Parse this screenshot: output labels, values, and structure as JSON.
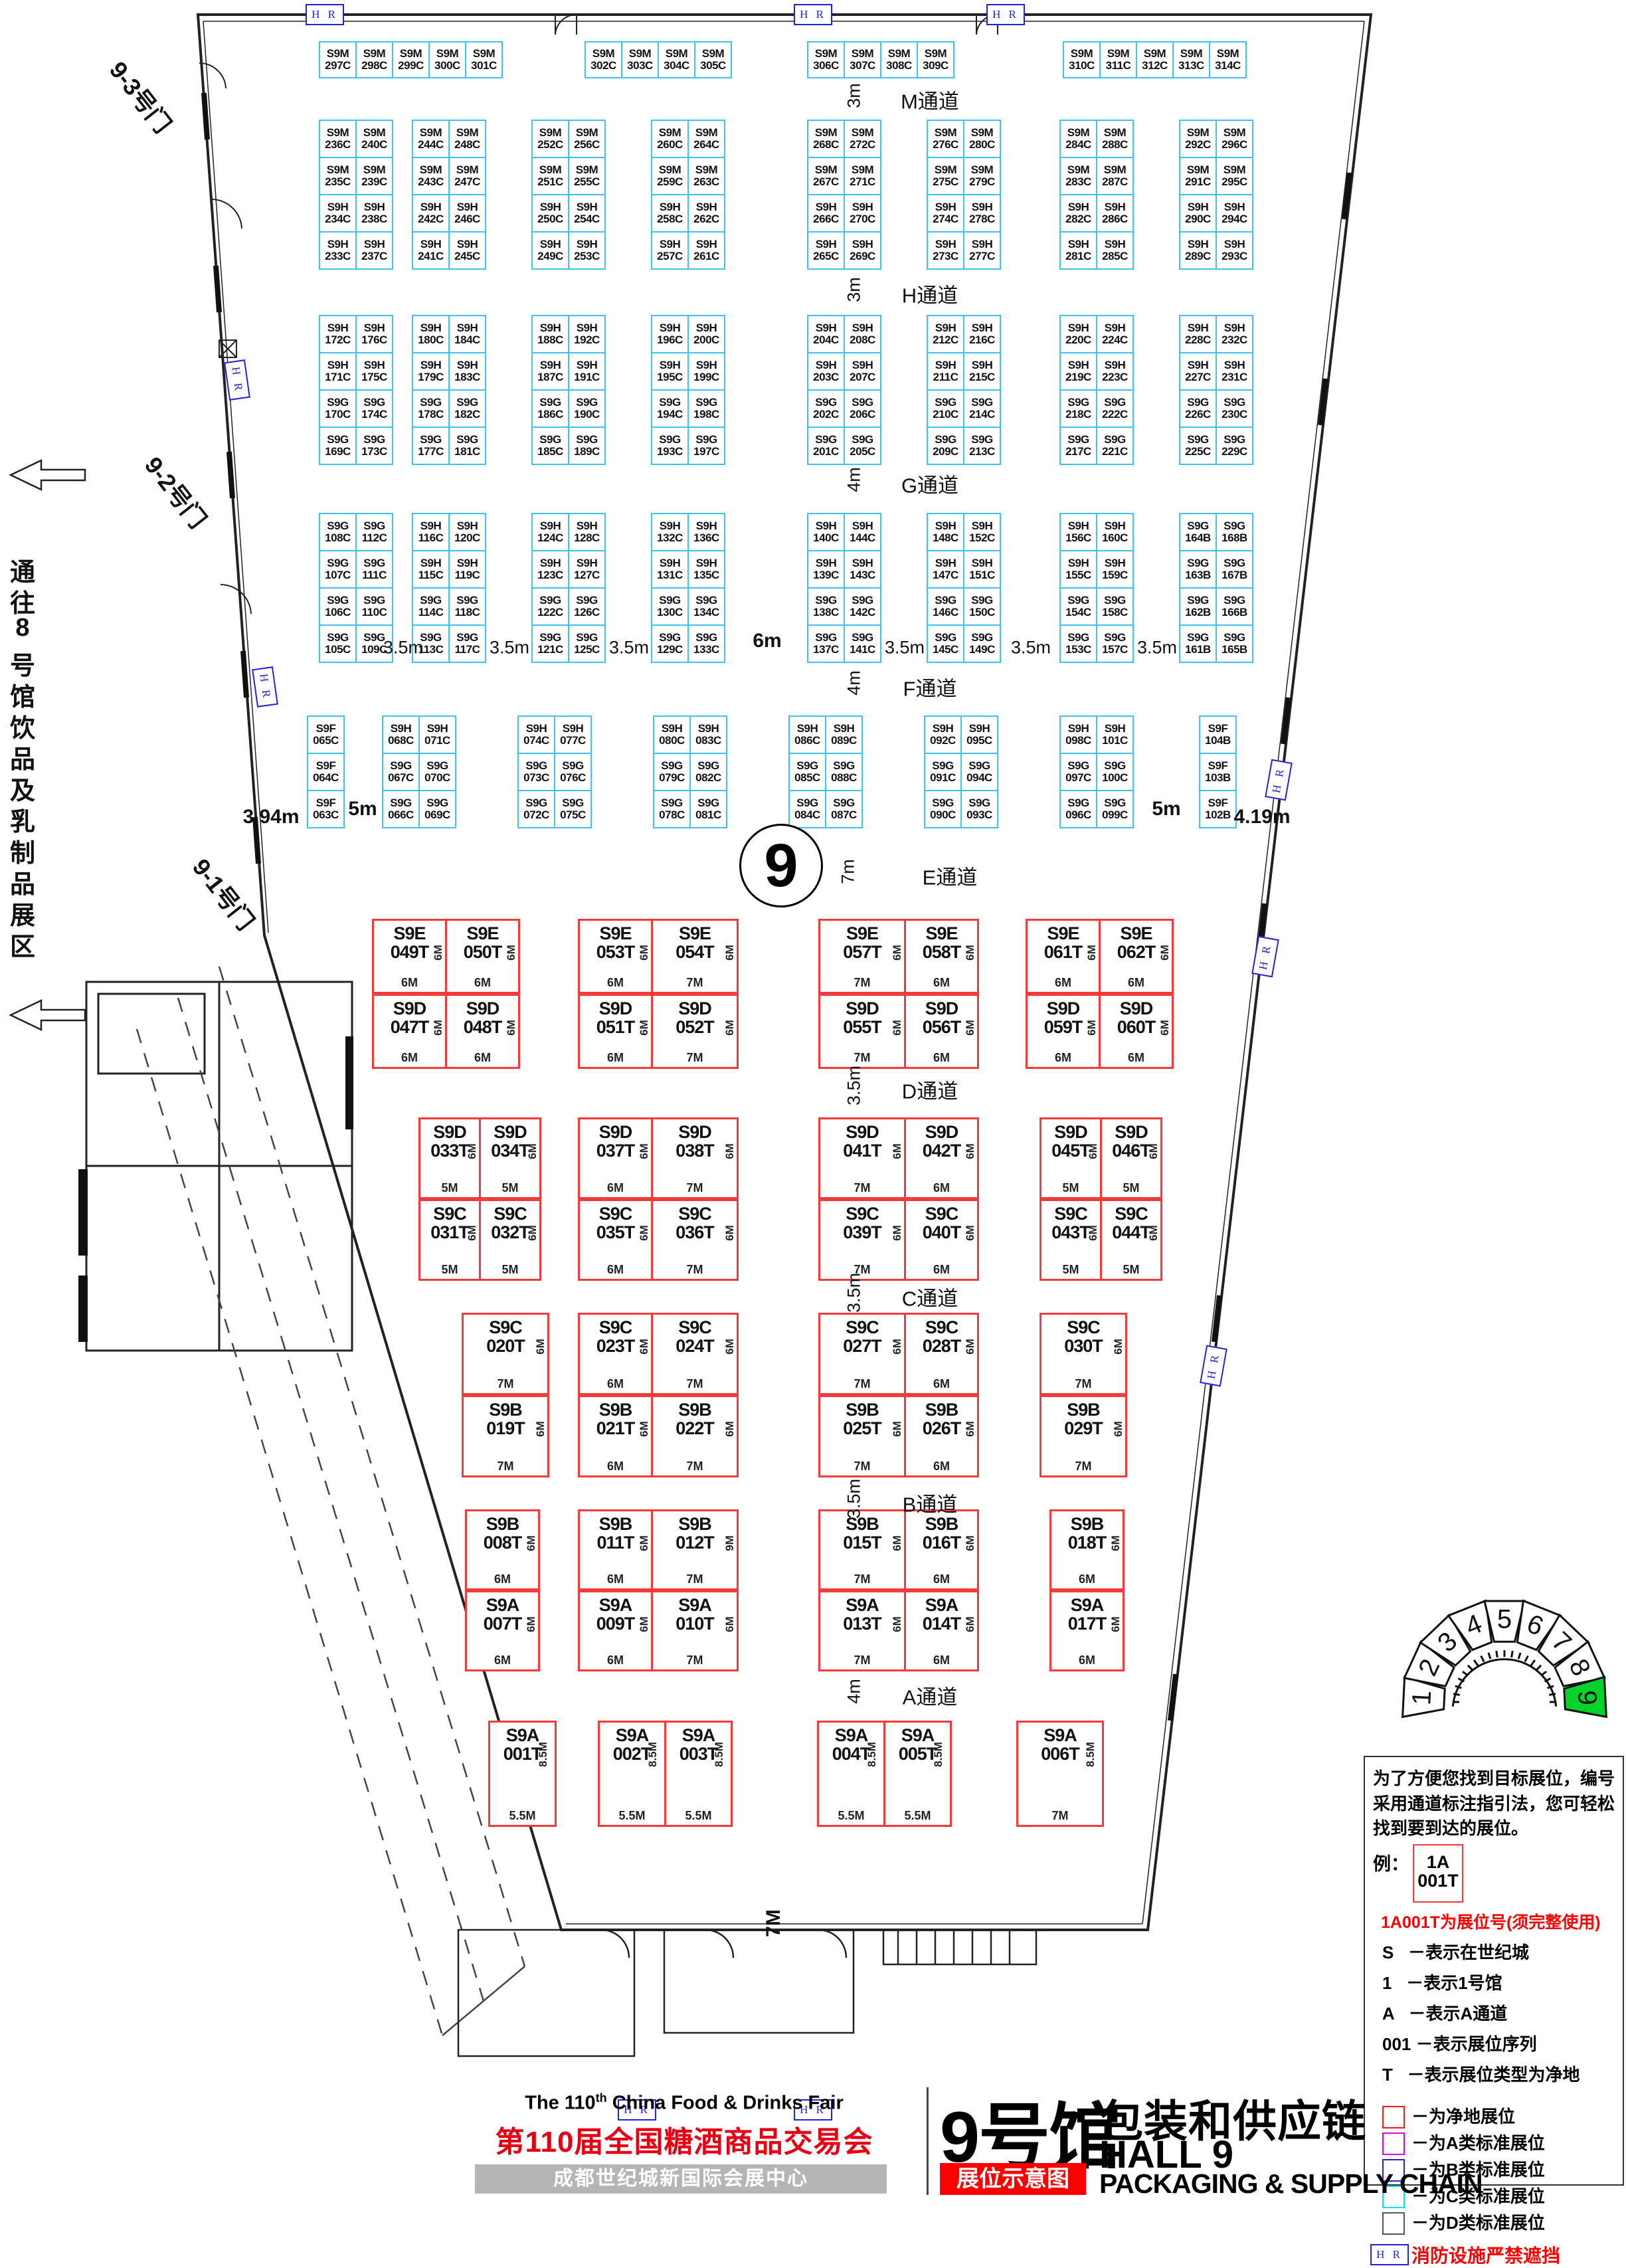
{
  "titles": {
    "en_pre": "The 110",
    "en_sup": "th",
    "en_post": " China Food & Drinks Fair",
    "cn": "第110届全国糖酒商品交易会",
    "venue": "成都世纪城新国际会展中心",
    "hall_cn_big": "9号馆",
    "hall_cn_sub": "包装和供应链",
    "hall_en": "HALL 9",
    "tag": "展位示意图",
    "en_sub": "PACKAGING & SUPPLY CHAIN"
  },
  "hall_circle": "9",
  "doors": [
    "9-3号门",
    "9-2号门",
    "9-1号门"
  ],
  "corridor_note": "通往8号馆饮品及乳制品展区",
  "fire_marker": "H R",
  "bottom_dim": "7M",
  "aisles": [
    {
      "label": "M通道",
      "dim": "3m"
    },
    {
      "label": "H通道",
      "dim": "3m"
    },
    {
      "label": "G通道",
      "dim": "4m"
    },
    {
      "label": "F通道",
      "dim": "4m"
    },
    {
      "label": "E通道",
      "dim": "7m"
    },
    {
      "label": "D通道",
      "dim": "3.5m"
    },
    {
      "label": "C通道",
      "dim": "3.5m"
    },
    {
      "label": "B通道",
      "dim": "3.5m"
    },
    {
      "label": "A通道",
      "dim": "4m"
    }
  ],
  "dim_labels": {
    "left": "3.94m",
    "right": "4.19m",
    "five": "5m",
    "gap": "3.5m",
    "mid": "6m"
  },
  "booths": {
    "row_m": [
      [
        "S9M|297C",
        "S9M|298C",
        "S9M|299C",
        "S9M|300C",
        "S9M|301C"
      ],
      [
        "S9M|302C",
        "S9M|303C",
        "S9M|304C",
        "S9M|305C"
      ],
      [
        "S9M|306C",
        "S9M|307C",
        "S9M|308C",
        "S9M|309C"
      ],
      [
        "S9M|310C",
        "S9M|311C",
        "S9M|312C",
        "S9M|313C",
        "S9M|314C"
      ]
    ],
    "block_mh": [
      [
        [
          "S9M|236C",
          "S9M|240C"
        ],
        [
          "S9M|235C",
          "S9M|239C"
        ],
        [
          "S9H|234C",
          "S9H|238C"
        ],
        [
          "S9H|233C",
          "S9H|237C"
        ]
      ],
      [
        [
          "S9M|244C",
          "S9M|248C"
        ],
        [
          "S9M|243C",
          "S9M|247C"
        ],
        [
          "S9H|242C",
          "S9H|246C"
        ],
        [
          "S9H|241C",
          "S9H|245C"
        ]
      ],
      [
        [
          "S9M|252C",
          "S9M|256C"
        ],
        [
          "S9M|251C",
          "S9M|255C"
        ],
        [
          "S9H|250C",
          "S9H|254C"
        ],
        [
          "S9H|249C",
          "S9H|253C"
        ]
      ],
      [
        [
          "S9M|260C",
          "S9M|264C"
        ],
        [
          "S9M|259C",
          "S9M|263C"
        ],
        [
          "S9H|258C",
          "S9H|262C"
        ],
        [
          "S9H|257C",
          "S9H|261C"
        ]
      ],
      [
        [
          "S9M|268C",
          "S9M|272C"
        ],
        [
          "S9M|267C",
          "S9M|271C"
        ],
        [
          "S9H|266C",
          "S9H|270C"
        ],
        [
          "S9H|265C",
          "S9H|269C"
        ]
      ],
      [
        [
          "S9M|276C",
          "S9M|280C"
        ],
        [
          "S9M|275C",
          "S9M|279C"
        ],
        [
          "S9H|274C",
          "S9H|278C"
        ],
        [
          "S9H|273C",
          "S9H|277C"
        ]
      ],
      [
        [
          "S9M|284C",
          "S9M|288C"
        ],
        [
          "S9M|283C",
          "S9M|287C"
        ],
        [
          "S9H|282C",
          "S9H|286C"
        ],
        [
          "S9H|281C",
          "S9H|285C"
        ]
      ],
      [
        [
          "S9M|292C",
          "S9M|296C"
        ],
        [
          "S9M|291C",
          "S9M|295C"
        ],
        [
          "S9H|290C",
          "S9H|294C"
        ],
        [
          "S9H|289C",
          "S9H|293C"
        ]
      ]
    ],
    "block_hg": [
      [
        [
          "S9H|172C",
          "S9H|176C"
        ],
        [
          "S9H|171C",
          "S9H|175C"
        ],
        [
          "S9G|170C",
          "S9G|174C"
        ],
        [
          "S9G|169C",
          "S9G|173C"
        ]
      ],
      [
        [
          "S9H|180C",
          "S9H|184C"
        ],
        [
          "S9H|179C",
          "S9H|183C"
        ],
        [
          "S9G|178C",
          "S9G|182C"
        ],
        [
          "S9G|177C",
          "S9G|181C"
        ]
      ],
      [
        [
          "S9H|188C",
          "S9H|192C"
        ],
        [
          "S9H|187C",
          "S9H|191C"
        ],
        [
          "S9G|186C",
          "S9G|190C"
        ],
        [
          "S9G|185C",
          "S9G|189C"
        ]
      ],
      [
        [
          "S9H|196C",
          "S9H|200C"
        ],
        [
          "S9H|195C",
          "S9H|199C"
        ],
        [
          "S9G|194C",
          "S9G|198C"
        ],
        [
          "S9G|193C",
          "S9G|197C"
        ]
      ],
      [
        [
          "S9H|204C",
          "S9H|208C"
        ],
        [
          "S9H|203C",
          "S9H|207C"
        ],
        [
          "S9G|202C",
          "S9G|206C"
        ],
        [
          "S9G|201C",
          "S9G|205C"
        ]
      ],
      [
        [
          "S9H|212C",
          "S9H|216C"
        ],
        [
          "S9H|211C",
          "S9H|215C"
        ],
        [
          "S9G|210C",
          "S9G|214C"
        ],
        [
          "S9G|209C",
          "S9G|213C"
        ]
      ],
      [
        [
          "S9H|220C",
          "S9H|224C"
        ],
        [
          "S9H|219C",
          "S9H|223C"
        ],
        [
          "S9G|218C",
          "S9G|222C"
        ],
        [
          "S9G|217C",
          "S9G|221C"
        ]
      ],
      [
        [
          "S9H|228C",
          "S9H|232C"
        ],
        [
          "S9H|227C",
          "S9H|231C"
        ],
        [
          "S9G|226C",
          "S9G|230C"
        ],
        [
          "S9G|225C",
          "S9G|229C"
        ]
      ]
    ],
    "block_gf": [
      [
        [
          "S9G|108C",
          "S9G|112C"
        ],
        [
          "S9G|107C",
          "S9G|111C"
        ],
        [
          "S9G|106C",
          "S9G|110C"
        ],
        [
          "S9G|105C",
          "S9G|109C"
        ]
      ],
      [
        [
          "S9H|116C",
          "S9H|120C"
        ],
        [
          "S9H|115C",
          "S9H|119C"
        ],
        [
          "S9G|114C",
          "S9G|118C"
        ],
        [
          "S9G|113C",
          "S9G|117C"
        ]
      ],
      [
        [
          "S9H|124C",
          "S9H|128C"
        ],
        [
          "S9H|123C",
          "S9H|127C"
        ],
        [
          "S9G|122C",
          "S9G|126C"
        ],
        [
          "S9G|121C",
          "S9G|125C"
        ]
      ],
      [
        [
          "S9H|132C",
          "S9H|136C"
        ],
        [
          "S9H|131C",
          "S9H|135C"
        ],
        [
          "S9G|130C",
          "S9G|134C"
        ],
        [
          "S9G|129C",
          "S9G|133C"
        ]
      ],
      [
        [
          "S9H|140C",
          "S9H|144C"
        ],
        [
          "S9H|139C",
          "S9H|143C"
        ],
        [
          "S9G|138C",
          "S9G|142C"
        ],
        [
          "S9G|137C",
          "S9G|141C"
        ]
      ],
      [
        [
          "S9H|148C",
          "S9H|152C"
        ],
        [
          "S9H|147C",
          "S9H|151C"
        ],
        [
          "S9G|146C",
          "S9G|150C"
        ],
        [
          "S9G|145C",
          "S9G|149C"
        ]
      ],
      [
        [
          "S9H|156C",
          "S9H|160C"
        ],
        [
          "S9H|155C",
          "S9H|159C"
        ],
        [
          "S9G|154C",
          "S9G|158C"
        ],
        [
          "S9G|153C",
          "S9G|157C"
        ]
      ],
      [
        [
          "S9G|164B",
          "S9G|168B"
        ],
        [
          "S9G|163B",
          "S9G|167B"
        ],
        [
          "S9G|162B",
          "S9G|166B"
        ],
        [
          "S9G|161B",
          "S9G|165B"
        ]
      ]
    ],
    "f_left": [
      "S9F|065C",
      "S9F|064C",
      "S9F|063C"
    ],
    "block_fe": [
      [
        [
          "S9H|068C",
          "S9H|071C"
        ],
        [
          "S9G|067C",
          "S9G|070C"
        ],
        [
          "S9G|066C",
          "S9G|069C"
        ]
      ],
      [
        [
          "S9H|074C",
          "S9H|077C"
        ],
        [
          "S9G|073C",
          "S9G|076C"
        ],
        [
          "S9G|072C",
          "S9G|075C"
        ]
      ],
      [
        [
          "S9H|080C",
          "S9H|083C"
        ],
        [
          "S9G|079C",
          "S9G|082C"
        ],
        [
          "S9G|078C",
          "S9G|081C"
        ]
      ],
      [
        [
          "S9H|086C",
          "S9H|089C"
        ],
        [
          "S9G|085C",
          "S9G|088C"
        ],
        [
          "S9G|084C",
          "S9G|087C"
        ]
      ],
      [
        [
          "S9H|092C",
          "S9H|095C"
        ],
        [
          "S9G|091C",
          "S9G|094C"
        ],
        [
          "S9G|090C",
          "S9G|093C"
        ]
      ],
      [
        [
          "S9H|098C",
          "S9H|101C"
        ],
        [
          "S9G|097C",
          "S9G|100C"
        ],
        [
          "S9G|096C",
          "S9G|099C"
        ]
      ]
    ],
    "f_right": [
      "S9F|104B",
      "S9F|103B",
      "S9F|102B"
    ],
    "red_ed": [
      [
        [
          "S9E|049T|6M|6M",
          "S9E|050T|6M|6M"
        ],
        [
          "S9D|047T|6M|6M",
          "S9D|048T|6M|6M"
        ]
      ],
      [
        [
          "S9E|053T|6M|6M",
          "S9E|054T|6M|7M"
        ],
        [
          "S9D|051T|6M|6M",
          "S9D|052T|6M|7M"
        ]
      ],
      [
        [
          "S9E|057T|6M|7M",
          "S9E|058T|6M|6M"
        ],
        [
          "S9D|055T|6M|7M",
          "S9D|056T|6M|6M"
        ]
      ],
      [
        [
          "S9E|061T|6M|6M",
          "S9E|062T|6M|6M"
        ],
        [
          "S9D|059T|6M|6M",
          "S9D|060T|6M|6M"
        ]
      ]
    ],
    "red_dc": [
      [
        [
          "S9D|033T|6M|5M",
          "S9D|034T|6M|5M"
        ],
        [
          "S9C|031T|6M|5M",
          "S9C|032T|6M|5M"
        ]
      ],
      [
        [
          "S9D|037T|6M|6M",
          "S9D|038T|6M|7M"
        ],
        [
          "S9C|035T|6M|6M",
          "S9C|036T|6M|7M"
        ]
      ],
      [
        [
          "S9D|041T|6M|7M",
          "S9D|042T|6M|6M"
        ],
        [
          "S9C|039T|6M|7M",
          "S9C|040T|6M|6M"
        ]
      ],
      [
        [
          "S9D|045T|6M|5M",
          "S9D|046T|6M|5M"
        ],
        [
          "S9C|043T|6M|5M",
          "S9C|044T|6M|5M"
        ]
      ]
    ],
    "red_cb": [
      [
        [
          "S9C|020T|6M|7M"
        ],
        [
          "S9B|019T|6M|7M"
        ]
      ],
      [
        [
          "S9C|023T|6M|6M",
          "S9C|024T|6M|7M"
        ],
        [
          "S9B|021T|6M|6M",
          "S9B|022T|6M|7M"
        ]
      ],
      [
        [
          "S9C|027T|6M|7M",
          "S9C|028T|6M|6M"
        ],
        [
          "S9B|025T|6M|7M",
          "S9B|026T|6M|6M"
        ]
      ],
      [
        [
          "S9C|030T|6M|7M"
        ],
        [
          "S9B|029T|6M|7M"
        ]
      ]
    ],
    "red_ba": [
      [
        [
          "S9B|008T|6M|6M"
        ],
        [
          "S9A|007T|6M|6M"
        ]
      ],
      [
        [
          "S9B|011T|6M|6M",
          "S9B|012T|9M|7M"
        ],
        [
          "S9A|009T|6M|6M",
          "S9A|010T|6M|7M"
        ]
      ],
      [
        [
          "S9B|015T|6M|7M",
          "S9B|016T|6M|6M"
        ],
        [
          "S9A|013T|6M|7M",
          "S9A|014T|6M|6M"
        ]
      ],
      [
        [
          "S9B|018T|6M|6M"
        ],
        [
          "S9A|017T|6M|6M"
        ]
      ]
    ],
    "red_a": [
      [
        [
          "S9A|001T|8.5M|5.5M"
        ]
      ],
      [
        [
          "S9A|002T|8.5M|5.5M",
          "S9A|003T|8.5M|5.5M"
        ]
      ],
      [
        [
          "S9A|004T|8.5M|5.5M",
          "S9A|005T|8.5M|5.5M"
        ]
      ],
      [
        [
          "S9A|006T|8.5M|7M"
        ]
      ]
    ]
  },
  "legend": {
    "intro": "为了方便您找到目标展位，编号采用通道标注指引法，您可轻松找到要到达的展位。",
    "example_label": "例：",
    "example_line1": "1A",
    "example_line2": "001T",
    "note": "1A001T为展位号(须完整使用)",
    "keys": [
      {
        "k": "S",
        "d": "－表示在世纪城"
      },
      {
        "k": "1",
        "d": "－表示1号馆"
      },
      {
        "k": "A",
        "d": "－表示A通道"
      },
      {
        "k": "001",
        "d": "－表示展位序列"
      },
      {
        "k": "T",
        "d": "－表示展位类型为净地"
      }
    ],
    "swatches": [
      {
        "color": "#ff1a1a",
        "label": "－为净地展位"
      },
      {
        "color": "#e400e4",
        "label": "－为A类标准展位"
      },
      {
        "color": "#2323d6",
        "label": "－为B类标准展位"
      },
      {
        "color": "#00e5ff",
        "label": "－为C类标准展位"
      },
      {
        "color": "#555555",
        "label": "－为D类标准展位"
      }
    ],
    "fire_label": "消防设施严禁遮挡"
  },
  "compass": {
    "halls": [
      "1",
      "2",
      "3",
      "4",
      "5",
      "6",
      "7",
      "8",
      "9"
    ],
    "current": "9",
    "highlight_color": "#00d42a"
  }
}
